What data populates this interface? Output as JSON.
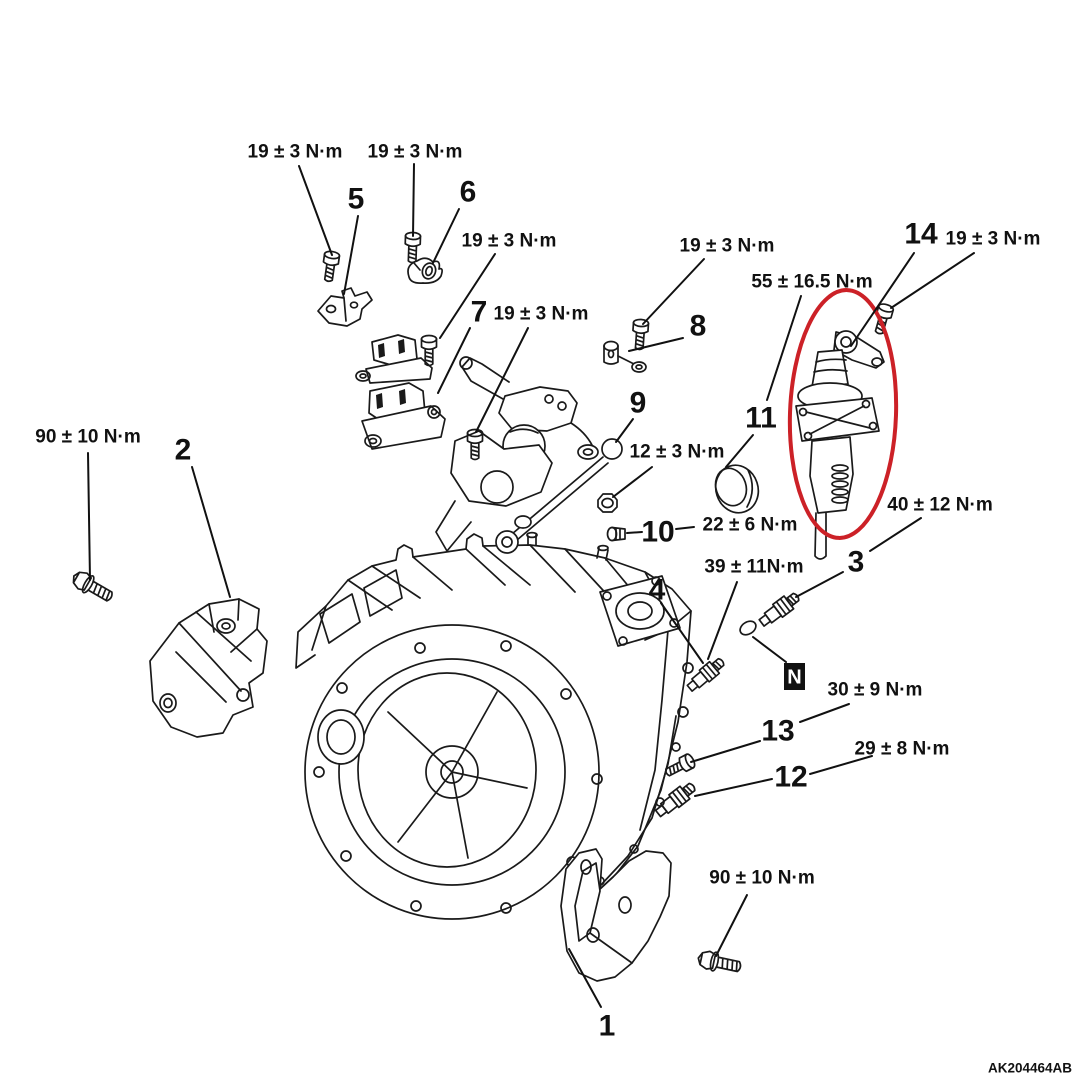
{
  "document": {
    "drawing_code": "AK204464AB",
    "units": "N·m"
  },
  "colors": {
    "background": "#ffffff",
    "line_art": "#1a1a1a",
    "text": "#111111",
    "highlight_ellipse": "#cc2127"
  },
  "callouts": {
    "torque_labels": [
      {
        "text": "19 ± 3 N·m",
        "x": 295,
        "y": 152,
        "leaders": [
          [
            299,
            166,
            332,
            255
          ]
        ]
      },
      {
        "text": "19 ± 3 N·m",
        "x": 415,
        "y": 152,
        "leaders": [
          [
            414,
            164,
            413,
            236
          ]
        ]
      },
      {
        "text": "19 ± 3 N·m",
        "x": 509,
        "y": 241,
        "leaders": [
          [
            495,
            254,
            440,
            338
          ]
        ]
      },
      {
        "text": "19 ± 3 N·m",
        "x": 541,
        "y": 314,
        "leaders": [
          [
            528,
            328,
            476,
            432
          ]
        ]
      },
      {
        "text": "19 ± 3 N·m",
        "x": 727,
        "y": 246,
        "leaders": [
          [
            704,
            259,
            643,
            324
          ]
        ]
      },
      {
        "text": "55 ± 16.5 N·m",
        "x": 812,
        "y": 282,
        "leaders": [
          [
            801,
            296,
            767,
            400
          ]
        ]
      },
      {
        "text": "19 ± 3 N·m",
        "x": 993,
        "y": 239,
        "leaders": [
          [
            974,
            253,
            891,
            308
          ]
        ]
      },
      {
        "text": "12 ± 3 N·m",
        "x": 677,
        "y": 452,
        "leaders": [
          [
            652,
            467,
            613,
            497
          ]
        ]
      },
      {
        "text": "22 ± 6 N·m",
        "x": 750,
        "y": 525,
        "leaders": [
          [
            694,
            527,
            676,
            529
          ]
        ]
      },
      {
        "text": "40 ± 12 N·m",
        "x": 940,
        "y": 505,
        "leaders": [
          [
            921,
            518,
            870,
            551
          ]
        ]
      },
      {
        "text": "39 ± 11N·m",
        "x": 754,
        "y": 567,
        "leaders": [
          [
            737,
            582,
            708,
            659
          ]
        ]
      },
      {
        "text": "30 ± 9 N·m",
        "x": 875,
        "y": 690,
        "leaders": [
          [
            849,
            704,
            800,
            722
          ]
        ]
      },
      {
        "text": "29 ± 8 N·m",
        "x": 902,
        "y": 749,
        "leaders": [
          [
            872,
            756,
            810,
            774
          ]
        ]
      },
      {
        "text": "90 ± 10 N·m",
        "x": 88,
        "y": 437,
        "leaders": [
          [
            88,
            453,
            90,
            580
          ]
        ]
      },
      {
        "text": "90 ± 10 N·m",
        "x": 762,
        "y": 878,
        "leaders": [
          [
            747,
            895,
            716,
            956
          ]
        ]
      }
    ],
    "part_numbers": [
      {
        "num": "1",
        "x": 607,
        "y": 1026,
        "leaders": [
          [
            601,
            1007,
            569,
            949
          ]
        ]
      },
      {
        "num": "2",
        "x": 183,
        "y": 450,
        "leaders": [
          [
            192,
            467,
            230,
            597
          ]
        ]
      },
      {
        "num": "3",
        "x": 856,
        "y": 562,
        "leaders": [
          [
            843,
            572,
            796,
            597
          ]
        ]
      },
      {
        "num": "4",
        "x": 657,
        "y": 590,
        "leaders": [
          [
            661,
            603,
            703,
            663
          ]
        ]
      },
      {
        "num": "5",
        "x": 356,
        "y": 199,
        "leaders": [
          [
            358,
            216,
            344,
            294
          ]
        ]
      },
      {
        "num": "6",
        "x": 468,
        "y": 192,
        "leaders": [
          [
            459,
            209,
            433,
            263
          ]
        ]
      },
      {
        "num": "7",
        "x": 479,
        "y": 312,
        "leaders": [
          [
            470,
            328,
            438,
            393
          ]
        ]
      },
      {
        "num": "8",
        "x": 698,
        "y": 326,
        "leaders": [
          [
            683,
            338,
            629,
            351
          ]
        ]
      },
      {
        "num": "9",
        "x": 638,
        "y": 403,
        "leaders": [
          [
            633,
            419,
            616,
            442
          ]
        ]
      },
      {
        "num": "10",
        "x": 658,
        "y": 532,
        "leaders": [
          [
            627,
            533,
            642,
            532
          ]
        ]
      },
      {
        "num": "11",
        "x": 761,
        "y": 418,
        "leaders": [
          [
            753,
            435,
            726,
            467
          ]
        ]
      },
      {
        "num": "12",
        "x": 791,
        "y": 777,
        "leaders": [
          [
            772,
            779,
            695,
            796
          ]
        ]
      },
      {
        "num": "13",
        "x": 778,
        "y": 731,
        "leaders": [
          [
            760,
            741,
            691,
            762
          ]
        ]
      },
      {
        "num": "14",
        "x": 921,
        "y": 234,
        "leaders": [
          [
            914,
            253,
            851,
            346
          ]
        ]
      }
    ],
    "new_part_symbol": {
      "text": "N",
      "box": [
        784,
        663,
        21,
        27
      ],
      "leaders": [
        [
          753,
          637,
          786,
          662
        ]
      ]
    },
    "drawing_code": {
      "text": "AK204464AB",
      "x": 1072,
      "y": 1068
    }
  }
}
